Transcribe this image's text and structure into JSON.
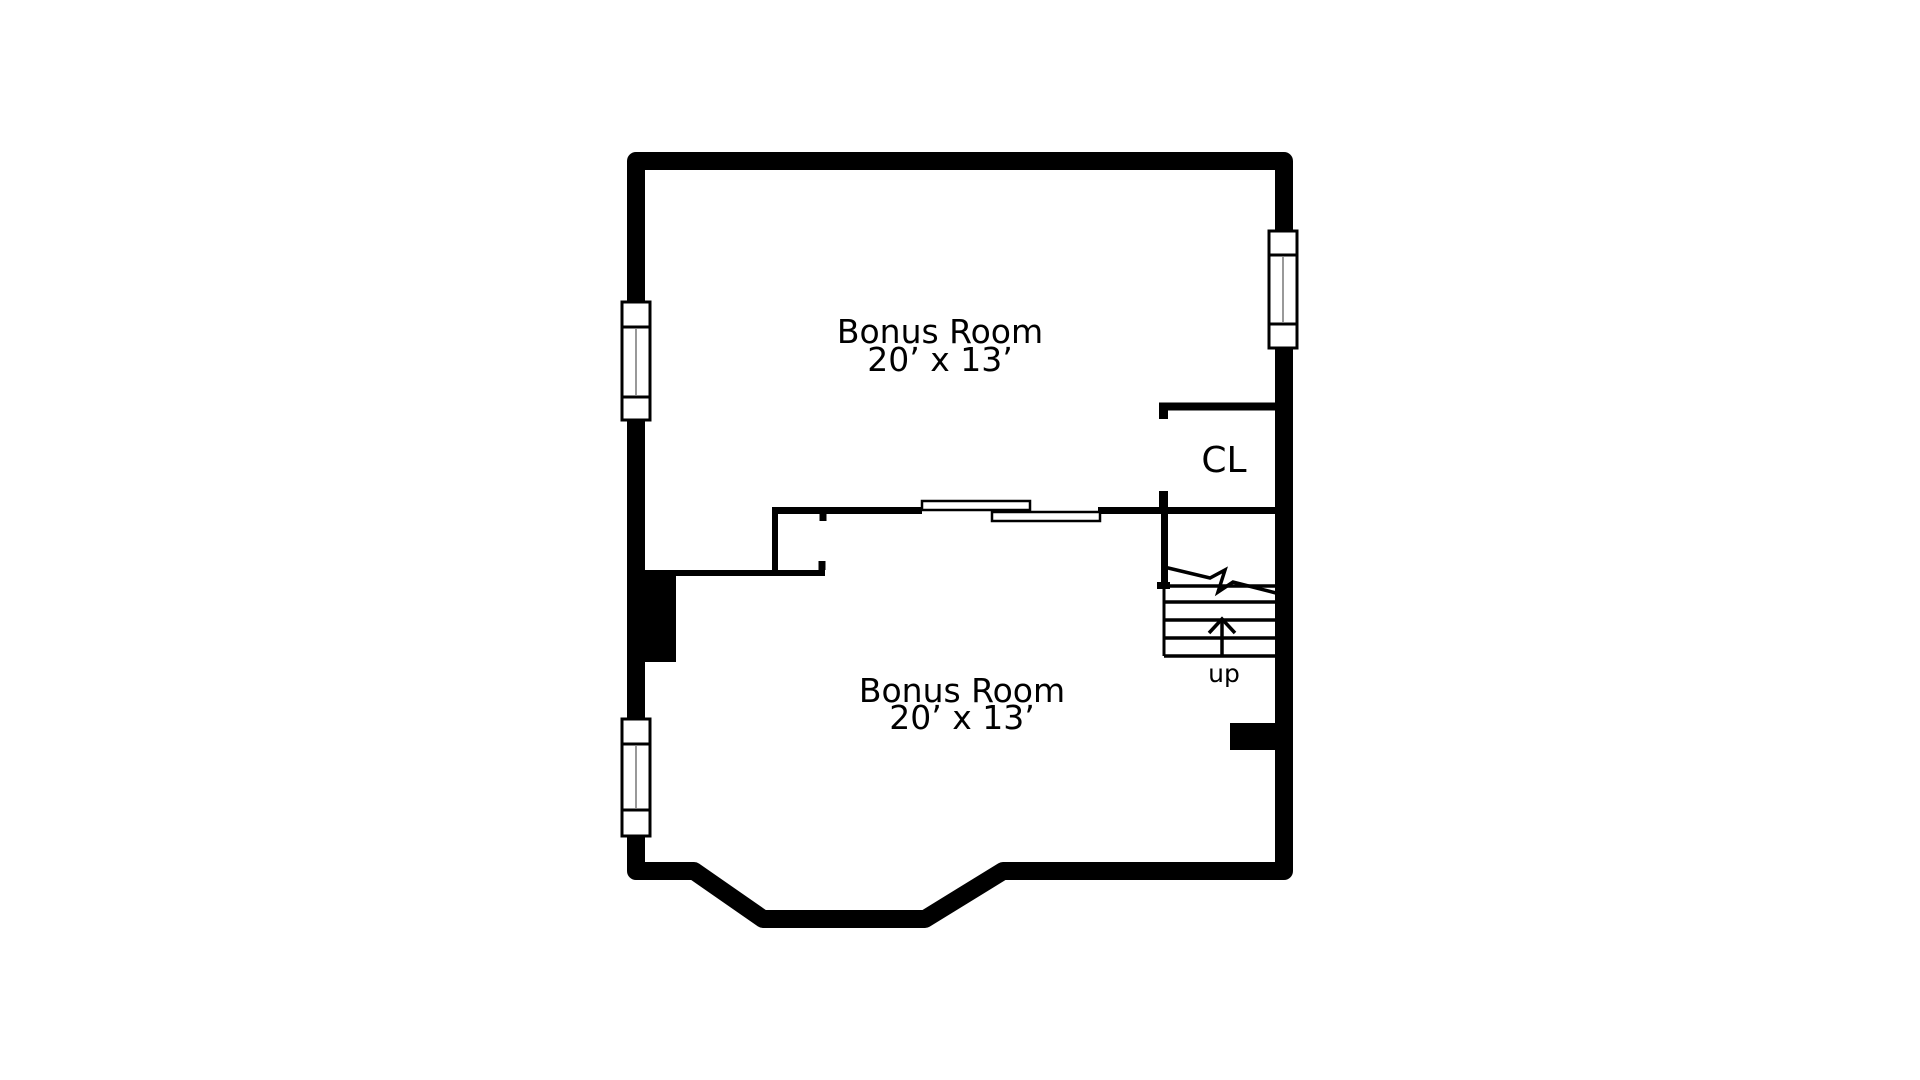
{
  "colors": {
    "walls": "#000000",
    "background": "#ffffff",
    "window_mullion": "#777777"
  },
  "floor_plan": {
    "rooms": [
      {
        "name": "Bonus Room",
        "dimensions": "20’ x 13’",
        "location": "upper"
      },
      {
        "name": "Bonus Room",
        "dimensions": "20’ x 13’",
        "location": "lower"
      }
    ],
    "closet": {
      "label": "CL"
    },
    "stairs": {
      "label": "up"
    },
    "symbols": {
      "windows": [
        {
          "wall": "left",
          "position": "upper"
        },
        {
          "wall": "left",
          "position": "lower"
        },
        {
          "wall": "right",
          "position": "upper"
        }
      ],
      "sliding_door": {
        "type": "bypass-two-panel",
        "between": "upper and lower bonus rooms"
      },
      "stair_break_line": true,
      "up_arrow": true
    }
  }
}
